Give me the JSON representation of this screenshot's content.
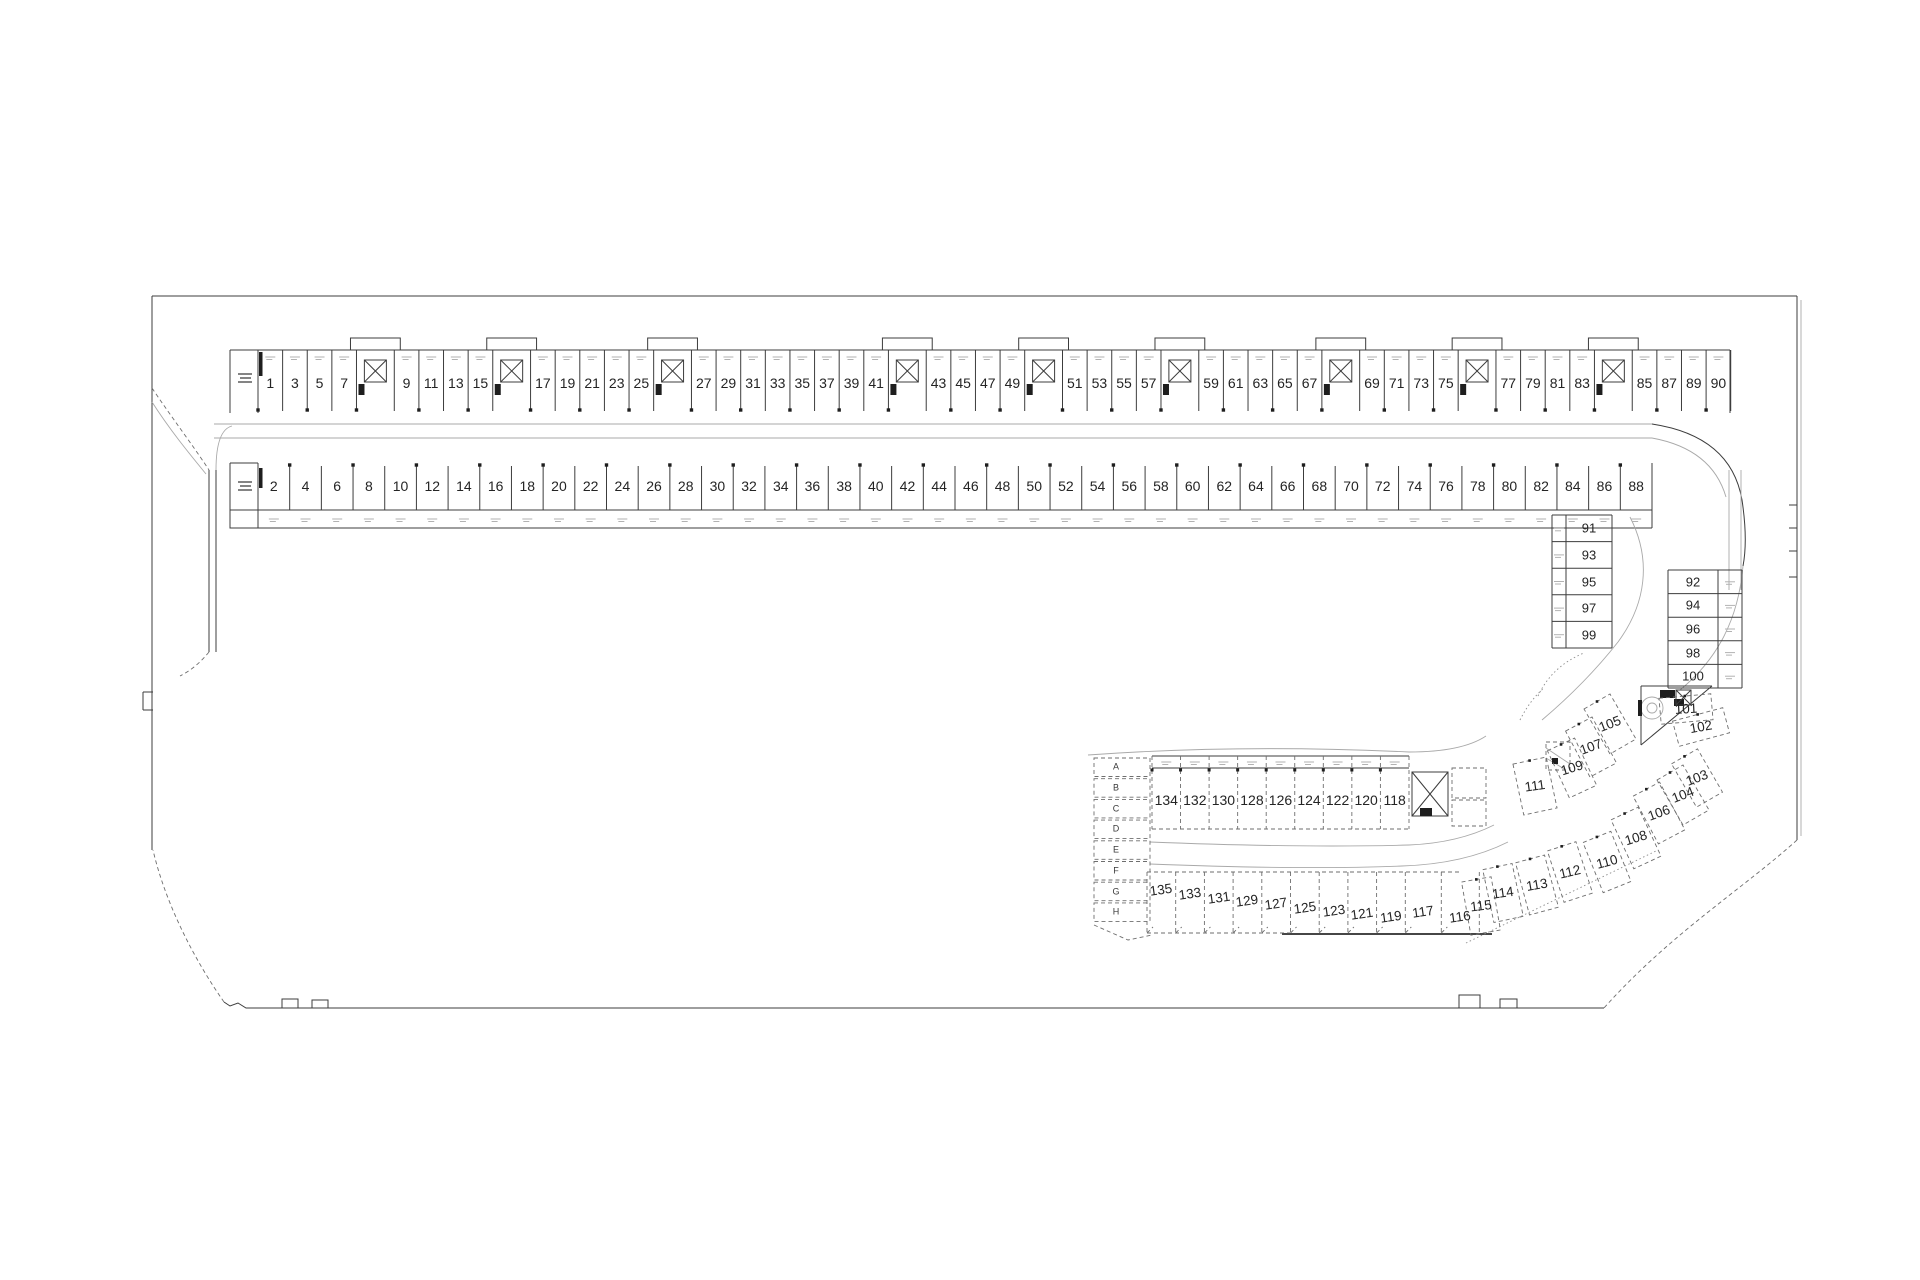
{
  "plan": {
    "background": "#ffffff",
    "ink": "#2f2f2f",
    "rows": {
      "top_row": {
        "cells": [
          "1",
          "3",
          "5",
          "7",
          "#",
          "9",
          "11",
          "13",
          "15",
          "#",
          "17",
          "19",
          "21",
          "23",
          "25",
          "#",
          "27",
          "29",
          "31",
          "33",
          "35",
          "37",
          "39",
          "41",
          "#",
          "43",
          "45",
          "47",
          "49",
          "#",
          "51",
          "53",
          "55",
          "57",
          "#",
          "59",
          "61",
          "63",
          "65",
          "67",
          "#",
          "69",
          "71",
          "73",
          "75",
          "#",
          "77",
          "79",
          "81",
          "83",
          "#",
          "85",
          "87",
          "89",
          "90"
        ]
      },
      "bottom_row": {
        "cells": [
          "2",
          "4",
          "6",
          "8",
          "10",
          "12",
          "14",
          "16",
          "18",
          "20",
          "22",
          "24",
          "26",
          "28",
          "30",
          "32",
          "34",
          "36",
          "38",
          "40",
          "42",
          "44",
          "46",
          "48",
          "50",
          "52",
          "54",
          "56",
          "58",
          "60",
          "62",
          "64",
          "66",
          "68",
          "70",
          "72",
          "74",
          "76",
          "78",
          "80",
          "82",
          "84",
          "86",
          "88"
        ]
      },
      "stack_left": {
        "cells": [
          "91",
          "93",
          "95",
          "97",
          "99"
        ]
      },
      "stack_right": {
        "cells": [
          "92",
          "94",
          "96",
          "98",
          "100"
        ]
      },
      "storage_letters": {
        "cells": [
          "A",
          "B",
          "C",
          "D",
          "E",
          "F",
          "G",
          "H"
        ]
      },
      "cluster_mid_row": {
        "cells": [
          "134",
          "132",
          "130",
          "128",
          "126",
          "124",
          "122",
          "120",
          "118"
        ]
      },
      "cluster_bottom_row": {
        "cells": [
          "135",
          "133",
          "131",
          "129",
          "127",
          "125",
          "123",
          "121",
          "119",
          "117",
          "116"
        ]
      },
      "cluster_diagonal": {
        "cells": [
          "111",
          "109",
          "107",
          "105",
          "115",
          "114",
          "113",
          "112",
          "110",
          "108",
          "106",
          "104",
          "103",
          "102",
          "101"
        ]
      }
    }
  }
}
